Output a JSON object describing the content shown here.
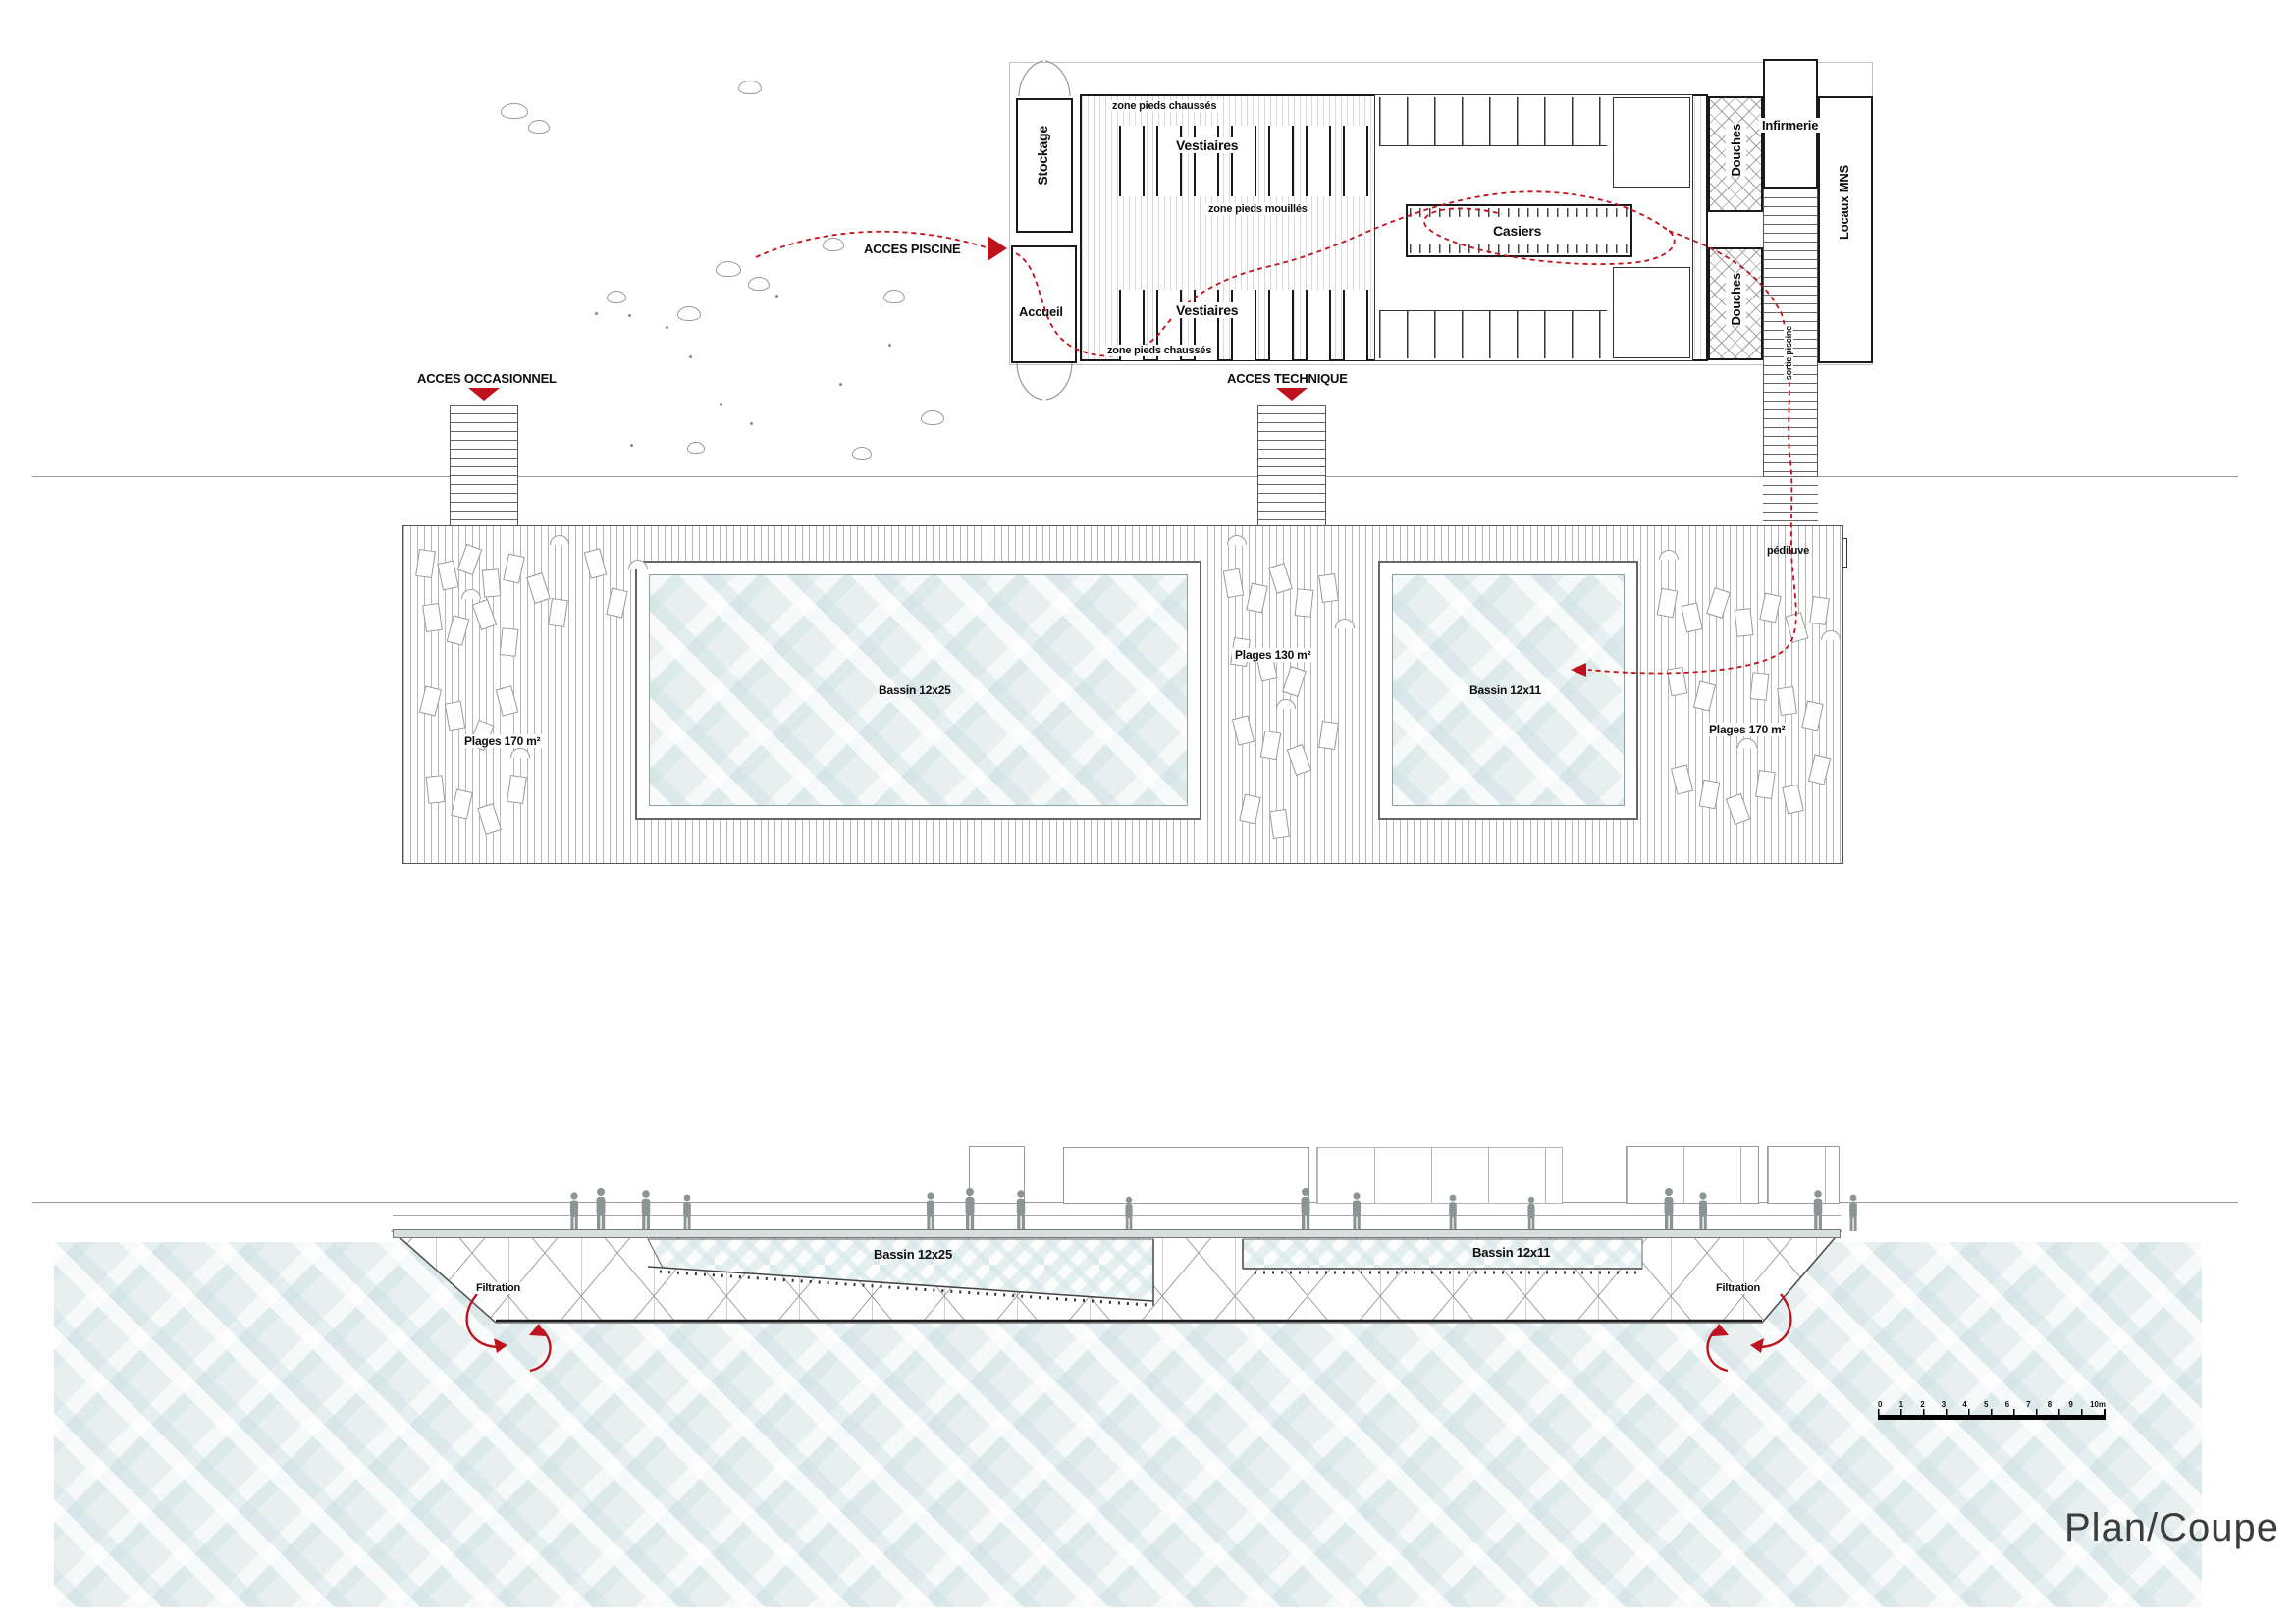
{
  "title": {
    "label": "Plan/Coupe"
  },
  "colors": {
    "accent_red": "#c0121c",
    "water_base": "#e7efef",
    "ink": "#0d0d0d",
    "grey_line": "#9a9a9a"
  },
  "plan": {
    "access_piscine": "ACCES PISCINE",
    "access_occasionnel": "ACCES OCCASIONNEL",
    "access_technique": "ACCES TECHNIQUE",
    "rooms": {
      "stockage": "Stockage",
      "accueil": "Accueil",
      "vestiaires_top": "Vestiaires",
      "vestiaires_bottom": "Vestiaires",
      "casiers": "Casiers",
      "douches_top": "Douches",
      "douches_bottom": "Douches",
      "infirmerie": "Infirmerie",
      "locaux_mns": "Locaux MNS"
    },
    "zones": {
      "pieds_chausses_top": "zone pieds chaussés",
      "pieds_chausses_bottom": "zone pieds chaussés",
      "pieds_mouilles": "zone pieds mouillés",
      "sortie_piscine": "sortie piscine",
      "pediluve": "pédiluve"
    },
    "deck": {
      "bassin_large": "Bassin 12x25",
      "bassin_small": "Bassin 12x11",
      "plages_left": "Plages 170 m²",
      "plages_center": "Plages 130 m²",
      "plages_right": "Plages 170 m²"
    }
  },
  "section": {
    "bassin_large": "Bassin 12x25",
    "bassin_small": "Bassin 12x11",
    "filtration_left": "Filtration",
    "filtration_right": "Filtration"
  },
  "scalebar": {
    "ticks": [
      "0",
      "1",
      "2",
      "3",
      "4",
      "5",
      "6",
      "7",
      "8",
      "9",
      "10m"
    ]
  }
}
